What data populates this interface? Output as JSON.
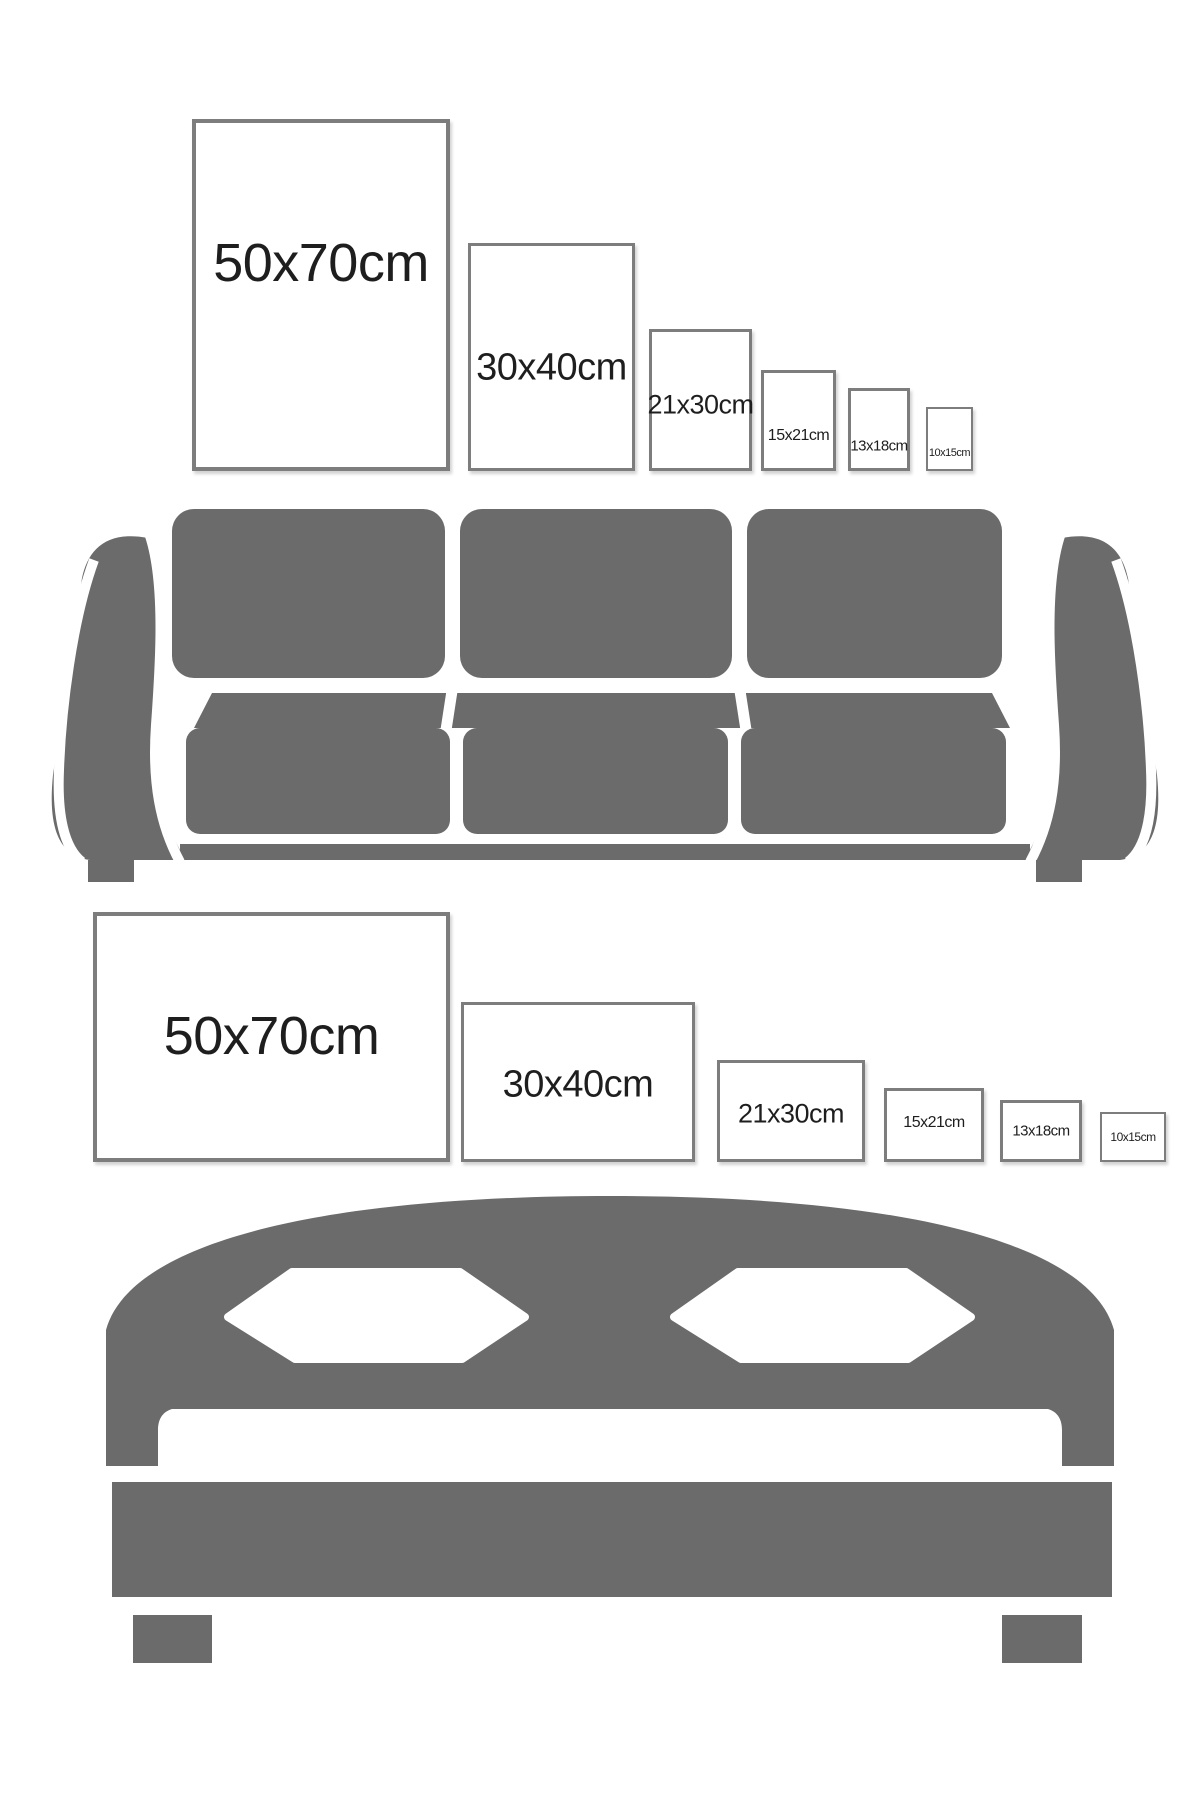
{
  "title": "Frame size comparison guide",
  "colors": {
    "furniture_gray": "#6b6b6b",
    "frame_border": "#7d7d7d",
    "label_text": "#1e1e1e",
    "background": "#ffffff"
  },
  "sections": [
    {
      "id": "sofa-wall",
      "furniture": "sofa",
      "furniture_icon": "sofa-icon",
      "frame_orientation": "portrait",
      "frames": [
        {
          "label": "50x70cm"
        },
        {
          "label": "30x40cm"
        },
        {
          "label": "21x30cm"
        },
        {
          "label": "15x21cm"
        },
        {
          "label": "13x18cm"
        },
        {
          "label": "10x15cm"
        }
      ]
    },
    {
      "id": "bed-wall",
      "furniture": "bed",
      "furniture_icon": "bed-icon",
      "frame_orientation": "landscape",
      "frames": [
        {
          "label": "50x70cm"
        },
        {
          "label": "30x40cm"
        },
        {
          "label": "21x30cm"
        },
        {
          "label": "15x21cm"
        },
        {
          "label": "13x18cm"
        },
        {
          "label": "10x15cm"
        }
      ]
    }
  ]
}
